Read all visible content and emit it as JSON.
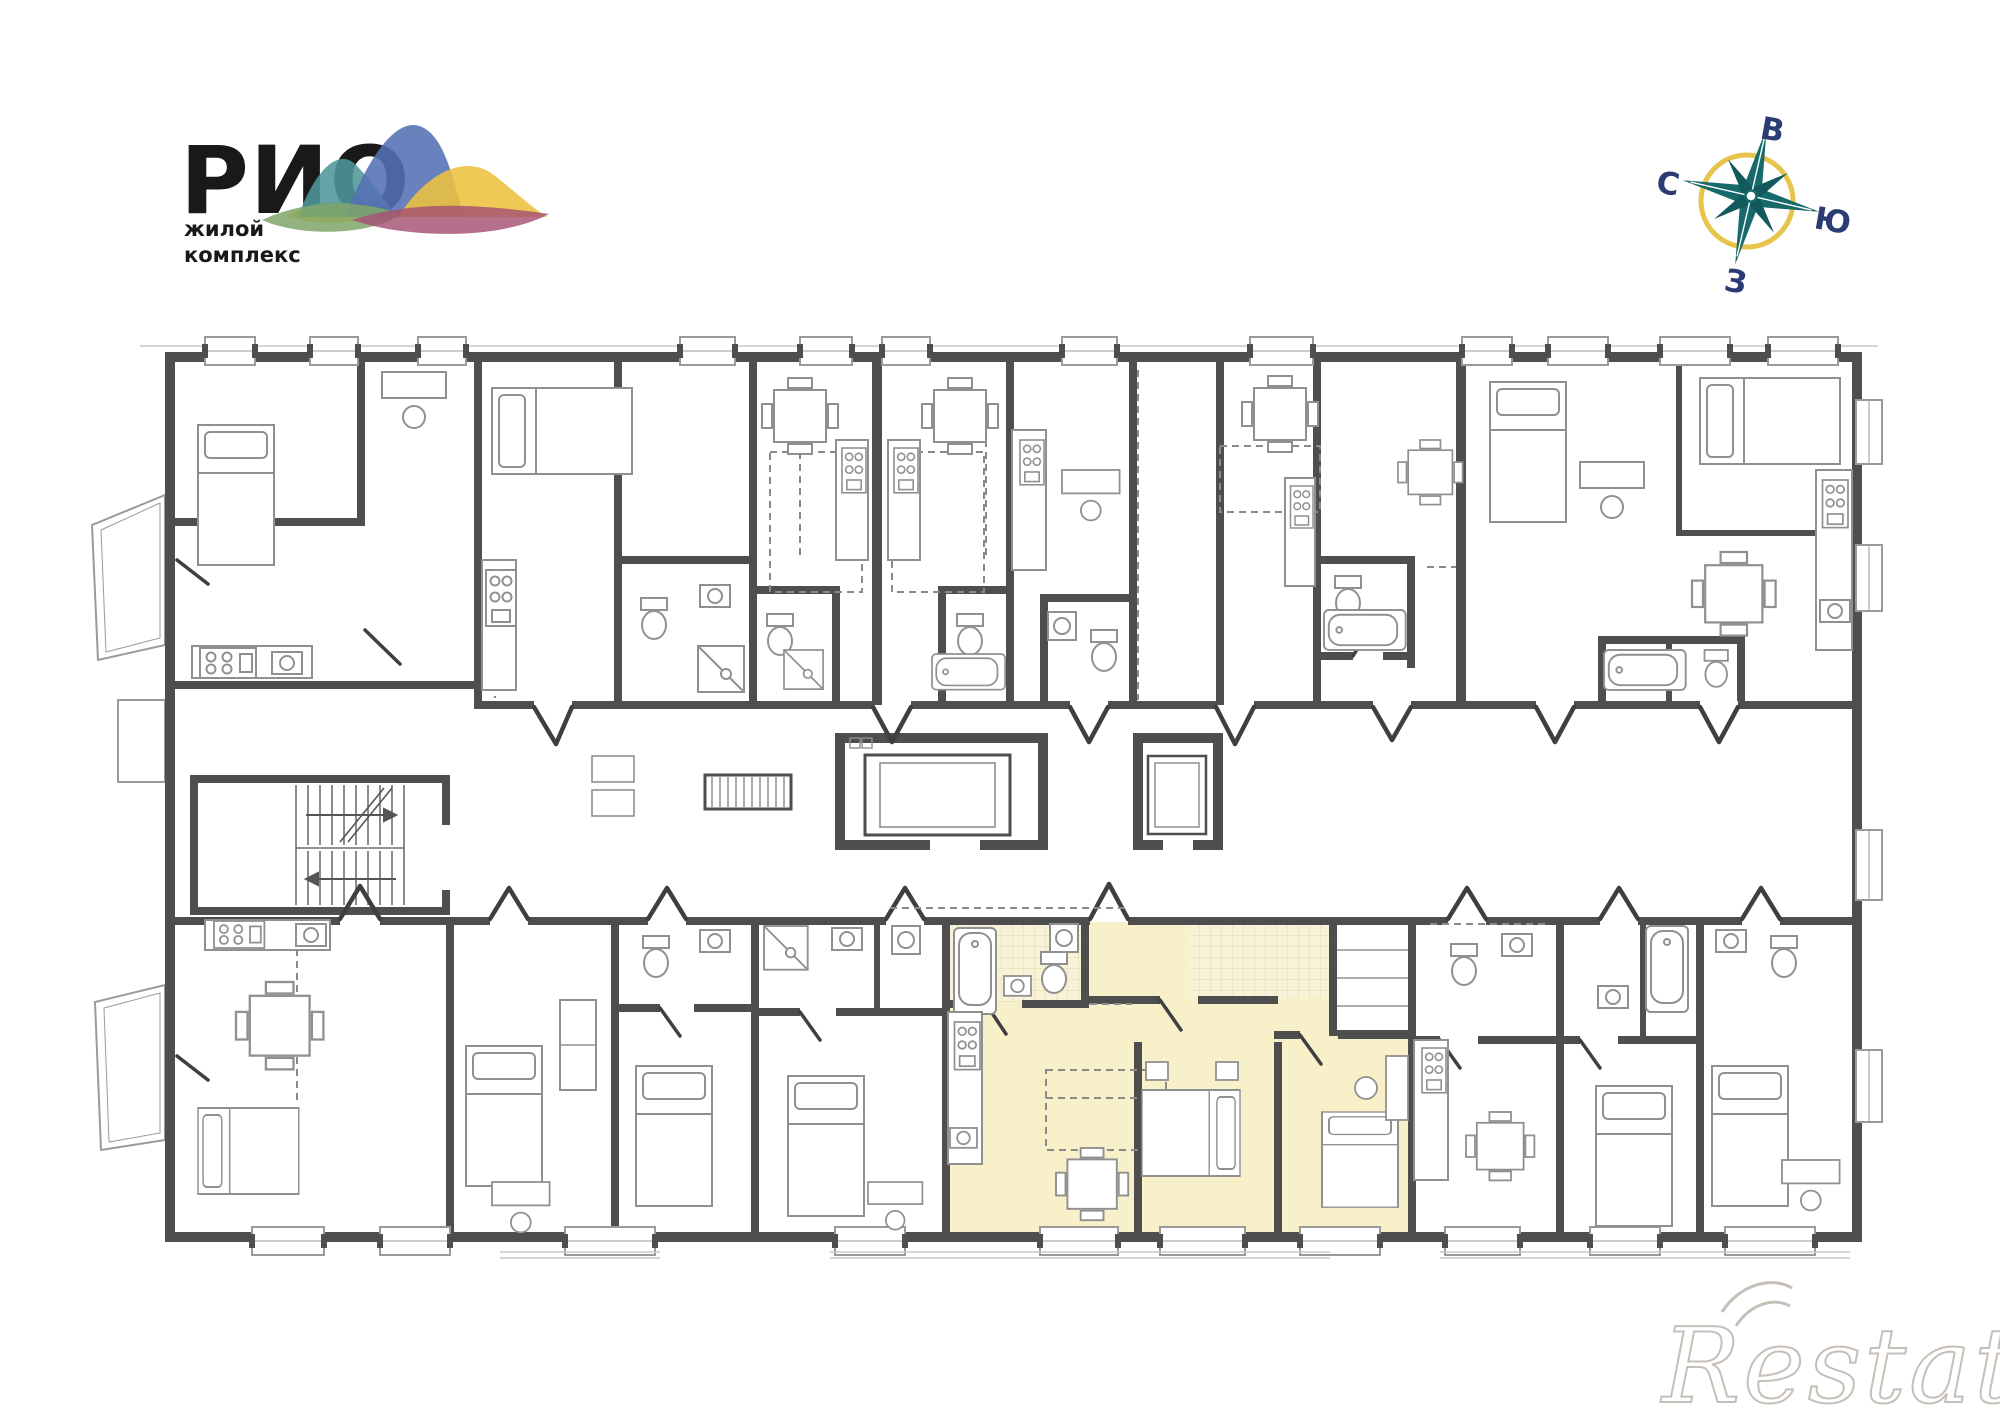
{
  "branding": {
    "logo_title": "РИО",
    "logo_subtitle_line1": "жилой",
    "logo_subtitle_line2": "комплекс",
    "logo_text_color": "#191919",
    "wave_colors": {
      "teal": "#4e979b",
      "blue": "#5471b4",
      "yellow": "#ecc13e",
      "green": "#7fa668",
      "magenta": "#a55073"
    }
  },
  "compass": {
    "east_label": "В",
    "south_label": "Ю",
    "west_label": "З",
    "north_label": "С",
    "star_color": "#17696a",
    "ring_color": "#e7c44b",
    "label_color": "#2b3c72"
  },
  "floor_plan": {
    "wall_color": "#4e4e4e",
    "furniture_line_color": "#909090",
    "window_line_color": "#9a9a9a",
    "elements": [
      "apartments",
      "corridor",
      "staircase",
      "elevator",
      "utility-shaft",
      "balconies",
      "windows",
      "doors"
    ],
    "highlighted_apartment": {
      "fill": "#f7f0c8",
      "tiled_fill": "#f8f3d8",
      "rooms": [
        "hallway",
        "bathroom",
        "kitchen-living",
        "bedroom-1",
        "bedroom-2"
      ]
    }
  },
  "watermark": {
    "text": "Restate",
    "color": "#c6bfb8"
  }
}
